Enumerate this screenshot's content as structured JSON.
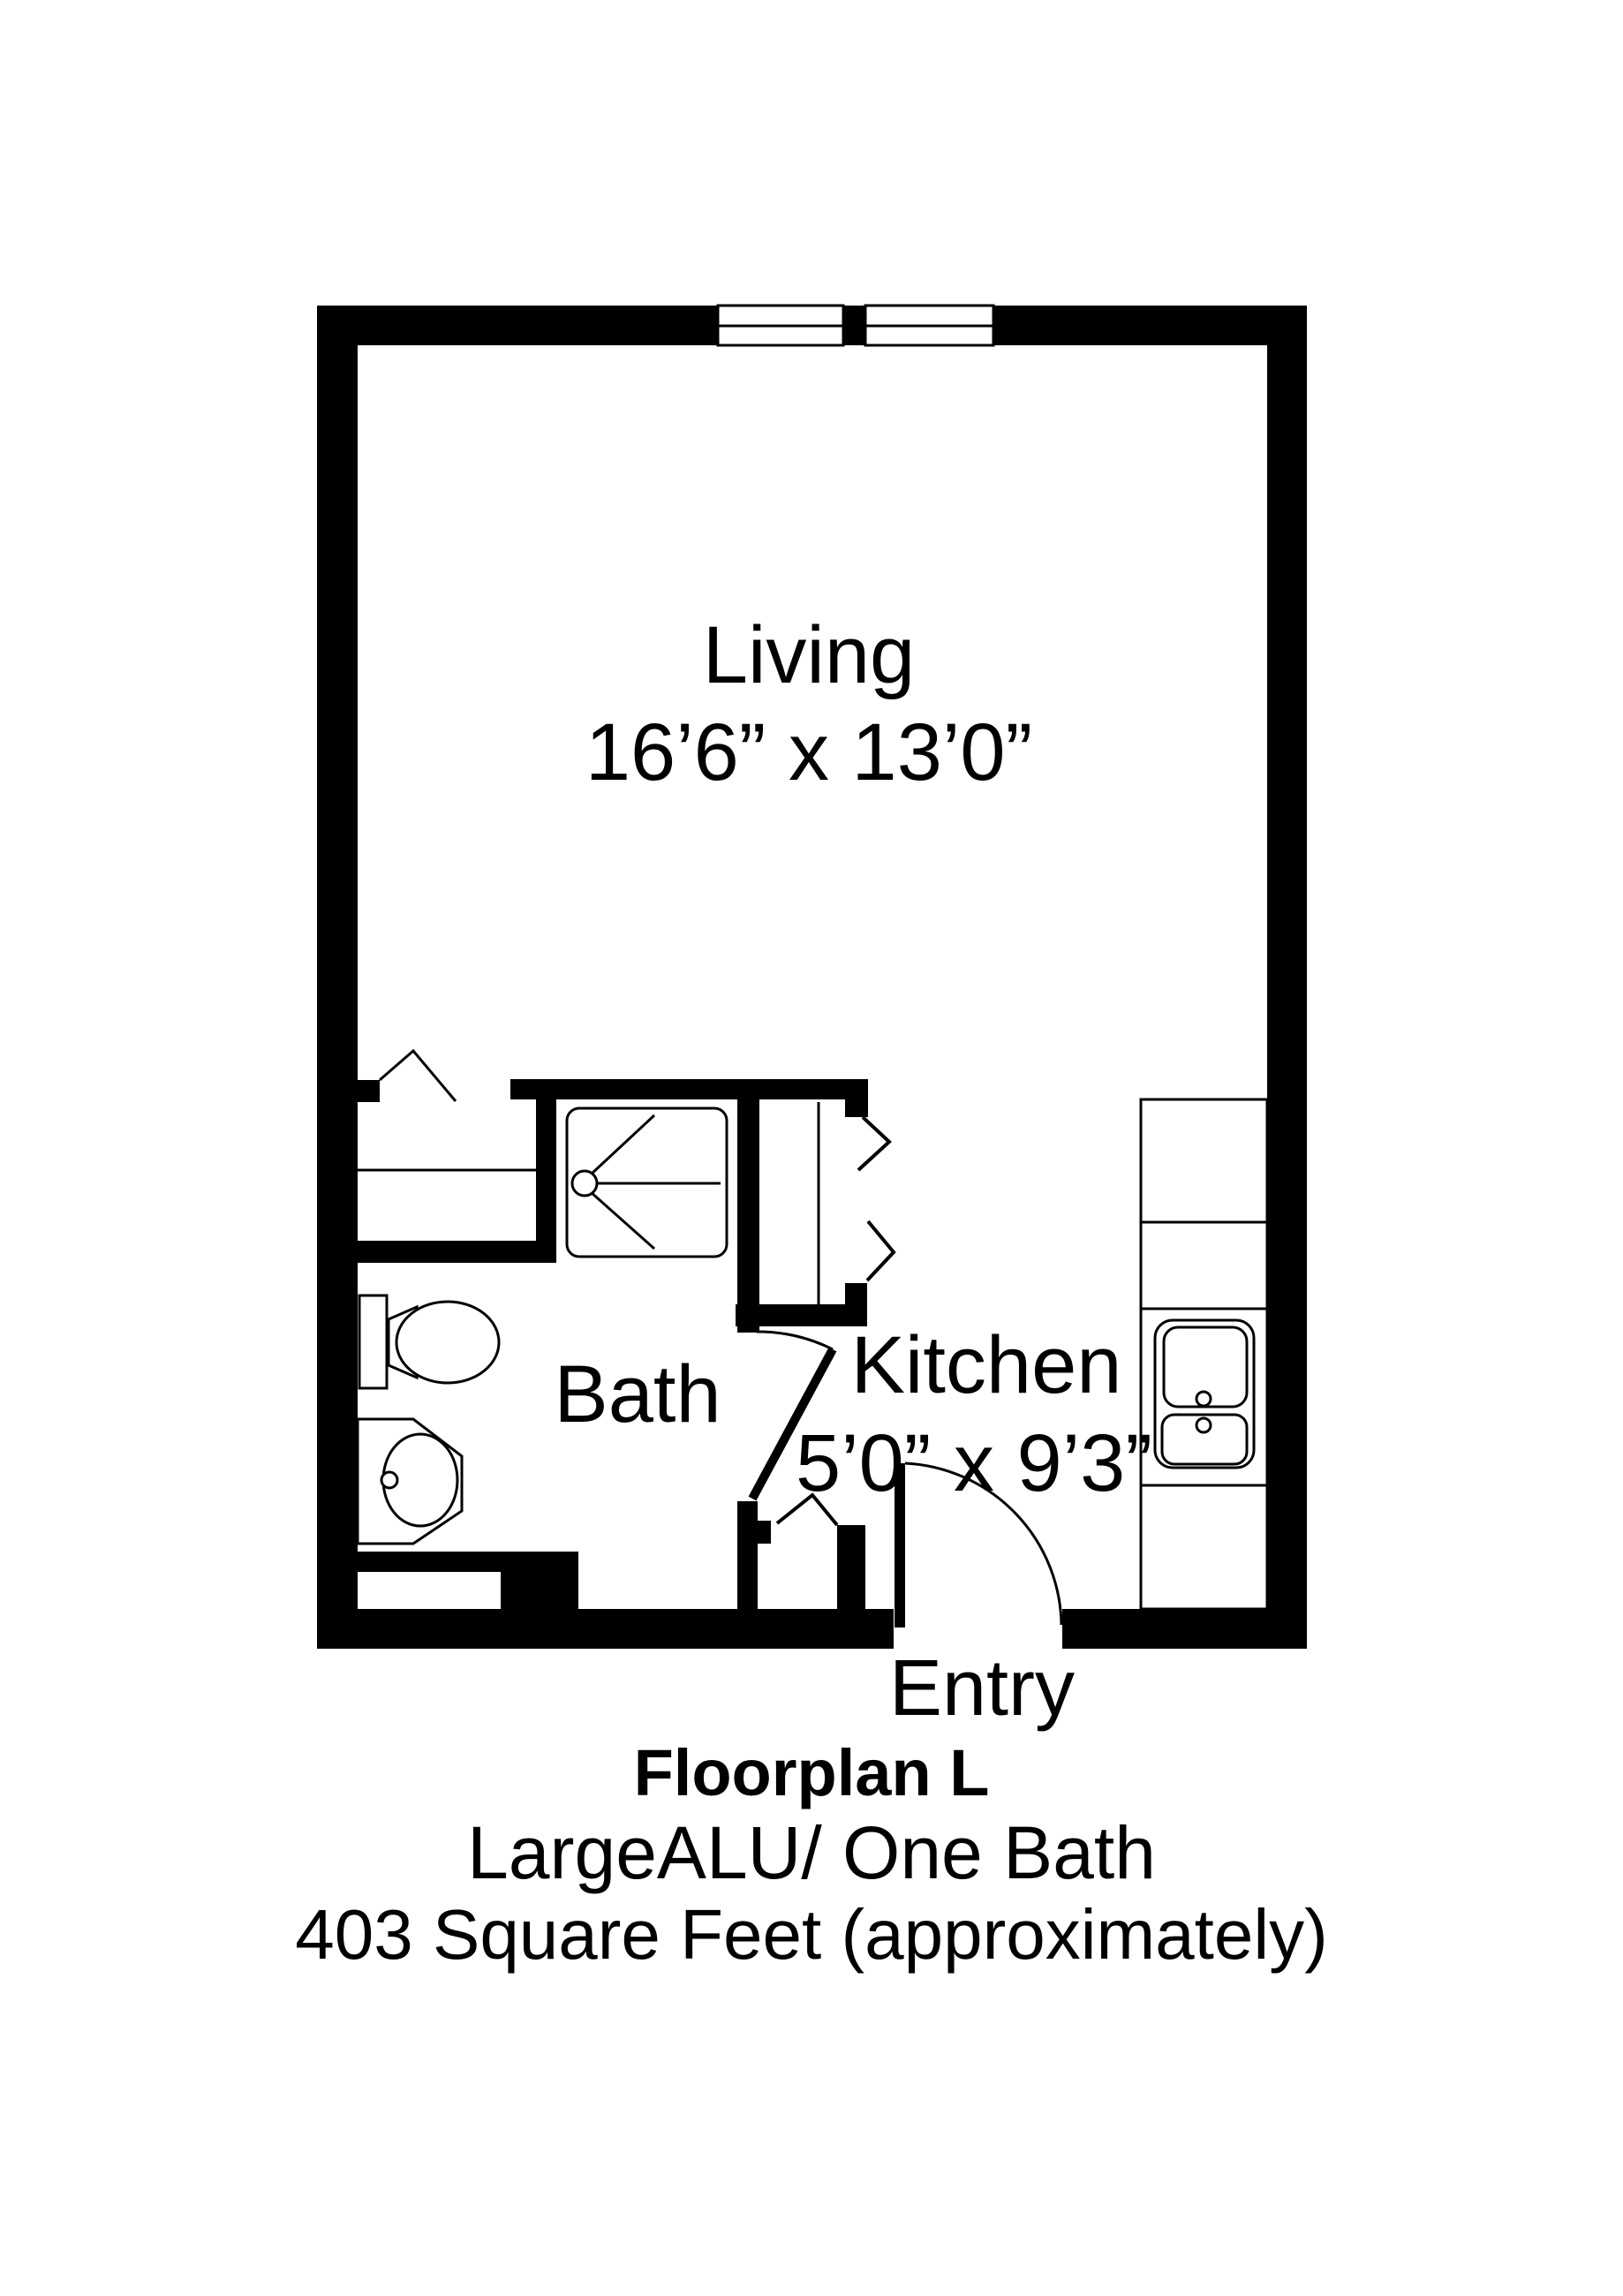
{
  "floorplan": {
    "title": "Floorplan L",
    "subtitle": "LargeALU/ One Bath",
    "area": "403 Square Feet (approximately)",
    "rooms": {
      "living": {
        "label": "Living",
        "dimensions": "16’6” x 13’0”"
      },
      "bath": {
        "label": "Bath"
      },
      "kitchen": {
        "label": "Kitchen",
        "dimensions": "5’0” x 9’3”"
      },
      "entry": {
        "label": "Entry"
      }
    },
    "fixtures": {
      "shower": "shower",
      "toilet": "toilet",
      "bath_sink": "bathroom-sink",
      "kitchen_sink": "kitchen-sink",
      "counter": "kitchen-counter",
      "pantry": "bifold-closet",
      "windows": "double-window"
    },
    "colors": {
      "ink": "#000000",
      "paper": "#ffffff"
    }
  }
}
